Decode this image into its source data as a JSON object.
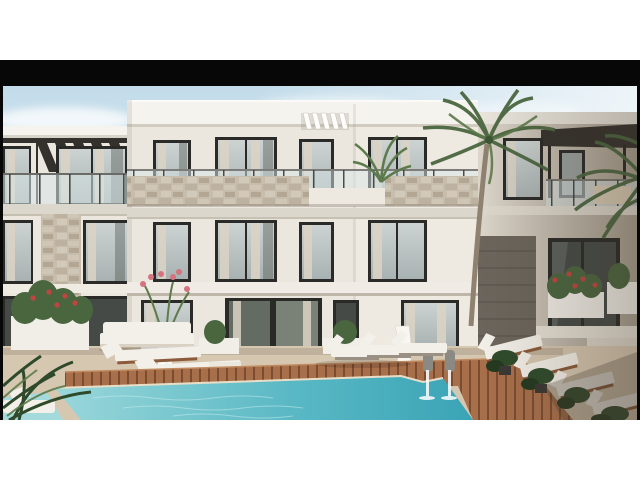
{
  "photo": {
    "frame_color": "#070707",
    "palette": {
      "page_bg": "#ffffff",
      "sky_top": "#c3dcea",
      "sky_mid": "#ddeaf1",
      "sky_bottom": "#f2f5f5",
      "cloud": "#ffffff",
      "wall_light": "#ebe7df",
      "wall_warm": "#dcd6cb",
      "wall_shadow": "#a89f90",
      "fascia": "#f5f3ee",
      "slab": "#dcd7cc",
      "stone": "#c7bdac",
      "stone_wall_dark": "#6b655c",
      "window_frame": "#2a2a28",
      "curtain": "#dbd3c4",
      "railing_glass": "#d9e5e8",
      "pergola_dark": "#34312c",
      "palm_green": "#4a663f",
      "palm_light": "#5d7a4c",
      "shrub_dark": "#2e4a2b",
      "flower_red": "#c04440",
      "flower_pink": "#d4737f",
      "trunk": "#8f8270",
      "paving": "#d6c7b0",
      "deck_wood": "#a86f4b",
      "deck_gap": "#7c4c30",
      "pool_light": "#9ad7da",
      "pool_mid": "#5bb9c5",
      "pool_deep": "#3aa4b6",
      "cushion": "#f3f0e9",
      "wood_frame": "#8a5a3a",
      "planter_white": "#f1eee7",
      "statue_grey": "#8b8984",
      "water_jet": "#ffffff"
    }
  }
}
